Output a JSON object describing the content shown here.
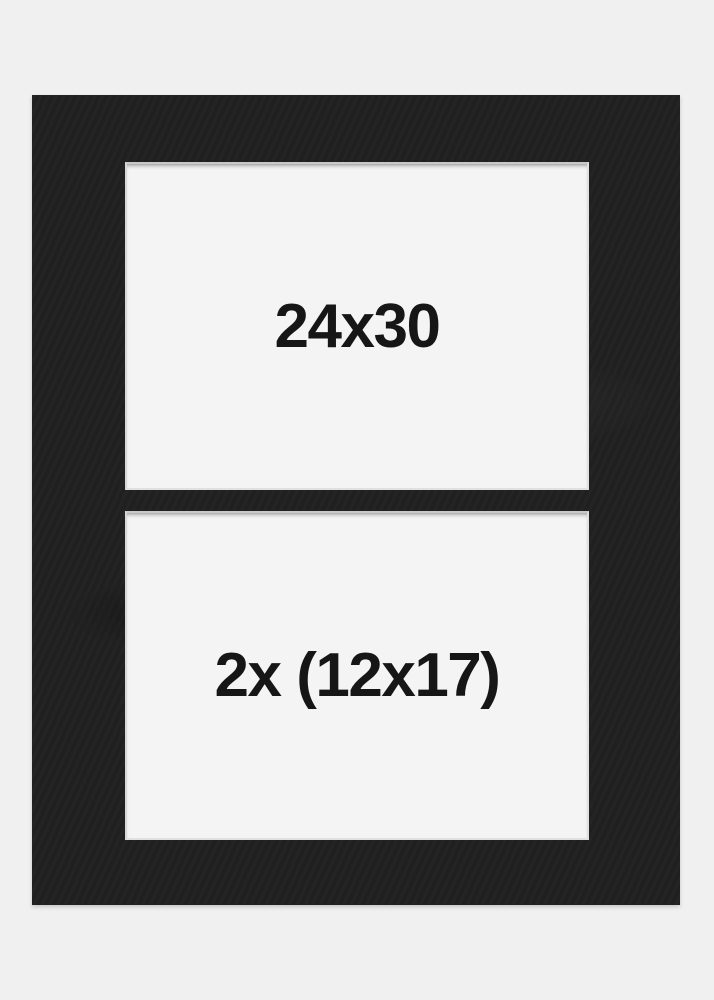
{
  "colors": {
    "background": "#f0f0f1",
    "mat_black": "#212121",
    "opening_white": "#f3f4f3",
    "bevel_edge": "#dfdfdf",
    "label_text": "#161616"
  },
  "mat": {
    "openings": [
      {
        "label": "24x30"
      },
      {
        "label": "2x (12x17)"
      }
    ]
  }
}
